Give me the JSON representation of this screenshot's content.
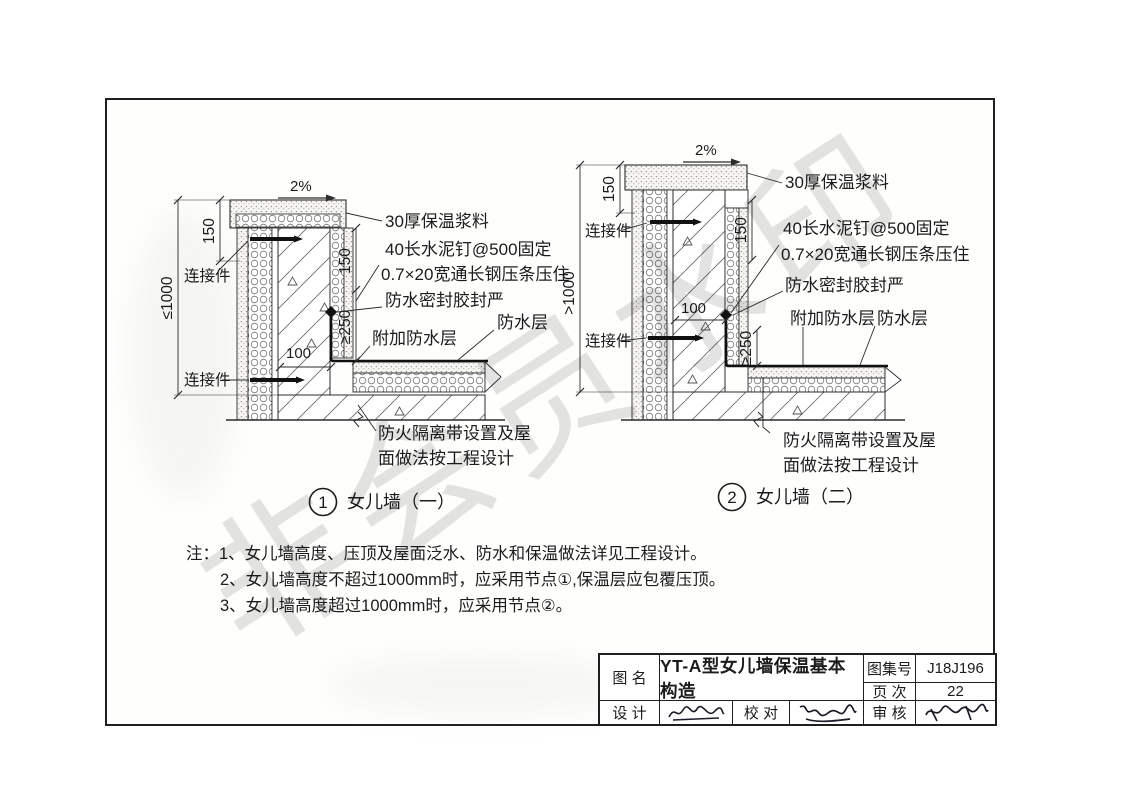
{
  "page": {
    "watermark": "非会员水印"
  },
  "shared": {
    "slope": "2%",
    "connector": "连接件",
    "labels": {
      "insulation_mortar": "30厚保温浆料",
      "cement_nail": "40长水泥钉@500固定",
      "steel_strip": "0.7×20宽通长钢压条压住",
      "sealant": "防水密封胶封严",
      "added_waterproof": "附加防水层",
      "waterproof": "防水层",
      "firebreak_1": "防火隔离带设置及屋",
      "firebreak_2": "面做法按工程设计"
    },
    "dims": {
      "d150": "150",
      "d250": "≥250",
      "d100": "100"
    }
  },
  "details": [
    {
      "no": "1",
      "title": "女儿墙（一）",
      "height_dim": "≤1000"
    },
    {
      "no": "2",
      "title": "女儿墙（二）",
      "height_dim": ">1000"
    }
  ],
  "notes": {
    "prefix": "注：",
    "items": [
      "1、女儿墙高度、压顶及屋面泛水、防水和保温做法详见工程设计。",
      "2、女儿墙高度不超过1000mm时，应采用节点①,保温层应包覆压顶。",
      "3、女儿墙高度超过1000mm时，应采用节点②。"
    ]
  },
  "titleblock": {
    "name_label": "图 名",
    "drawing_name": "YT-A型女儿墙保温基本构造",
    "atlas_label": "图集号",
    "atlas_no": "J18J196",
    "page_label": "页 次",
    "page_no": "22",
    "design_label": "设 计",
    "proof_label": "校 对",
    "review_label": "审 核"
  }
}
